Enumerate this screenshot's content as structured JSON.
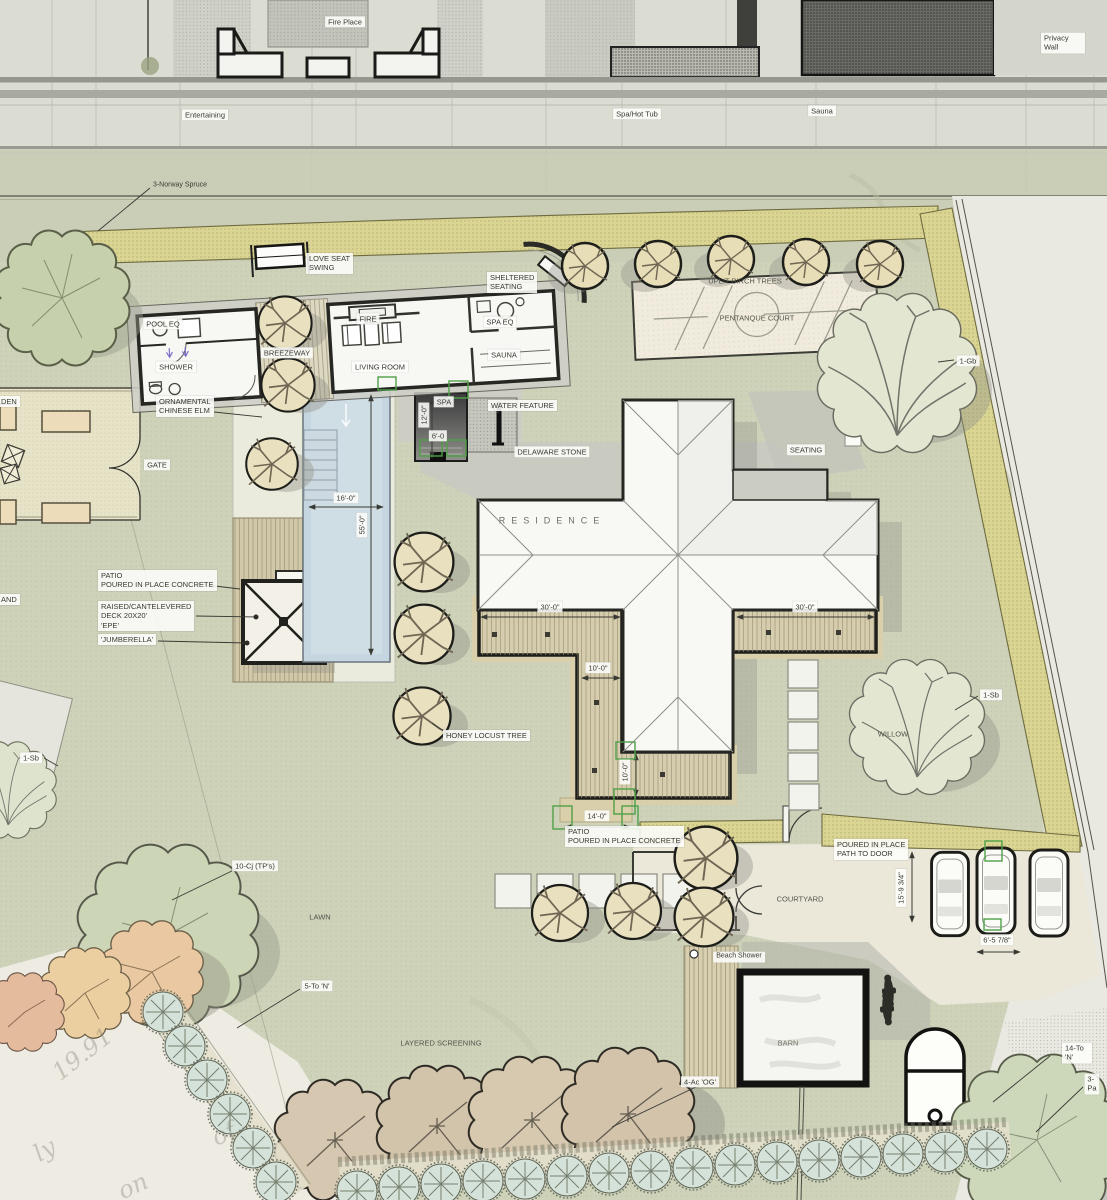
{
  "elevation": {
    "fire_place": "Fire Place",
    "privacy_wall": "Privacy Wall",
    "entertaining": "Entertaining",
    "spa_hot_tub": "Spa/Hot Tub",
    "sauna": "Sauna"
  },
  "site": {
    "norway_spruce": "3-Norway Spruce",
    "love_seat_swing": "LOVE SEAT\nSWING",
    "sheltered_seating": "SHELTERED\nSEATING",
    "pool_eq": "POOL EQ",
    "spa_eq": "SPA EQ",
    "shower": "SHOWER",
    "breezeway": "BREEZEWAY",
    "fire": "FIRE",
    "living_room": "LIVING ROOM",
    "sauna_room": "SAUNA",
    "ornamental_elm": "ORNAMENTAL\nCHINESE ELM",
    "spa": "SPA",
    "water_feature": "WATER FEATURE",
    "delaware_stone": "DELAWARE STONE",
    "gate": "GATE",
    "garden_fragment": "DEN",
    "island_fragment": "AND",
    "uplit_birch": "UPLIT BIRCH TREES",
    "pentanque_court": "PENTANQUE COURT",
    "seating": "SEATING",
    "residence": "RESIDENCE",
    "patio_left": "PATIO\nPOURED IN PLACE CONCRETE",
    "raised_deck": "RAISED/CANTELEVERED\nDECK 20X20'\n'EPE'",
    "jumberella": "'JUMBERELLA'",
    "honey_locust": "HONEY LOCUST TREE",
    "willow": "WILLOW",
    "patio_bottom": "PATIO\nPOURED IN PLACE CONCRETE",
    "path_to_door": "POURED IN PLACE\nPATH TO DOOR",
    "courtyard": "COURTYARD",
    "beach_shower": "Beach Shower",
    "barn": "BARN",
    "lawn": "LAWN",
    "layered_screening": "LAYERED SCREENING"
  },
  "tags": {
    "gb_1": "1-Gb",
    "sb_1_left": "1-Sb",
    "sb_1_right": "1-Sb",
    "cj_10": "10-Cj (TP's)",
    "to_5": "5-To 'N'",
    "ac_4": "4-Ac 'OG'",
    "to_14": "14-To 'N'",
    "pa_3": "3-Pa"
  },
  "dims": {
    "pool_w": "16'-0\"",
    "pool_l": "55'-0\"",
    "spa_l": "12'-0\"",
    "spa_w": "6'-0",
    "deck_30_left": "30'-0\"",
    "deck_10_mid": "10'-0\"",
    "deck_30_right": "30'-0\"",
    "deck_10_bottom": "10'-0\"",
    "patio_14": "14'-0\"",
    "park_depth": "15'-9 3/4\"",
    "park_width": "6'-5 7/8\""
  },
  "ghost": {
    "g1": "19.91",
    "g2": "of",
    "g3": "ly",
    "g4": "on"
  },
  "colors": {
    "lawn": "#cdd2b9",
    "hedge": "#dbd594",
    "pool": "#c6d6e0",
    "deck": "#d5cdad",
    "outside": "#e9e8e1",
    "registration": "#4fa047"
  }
}
